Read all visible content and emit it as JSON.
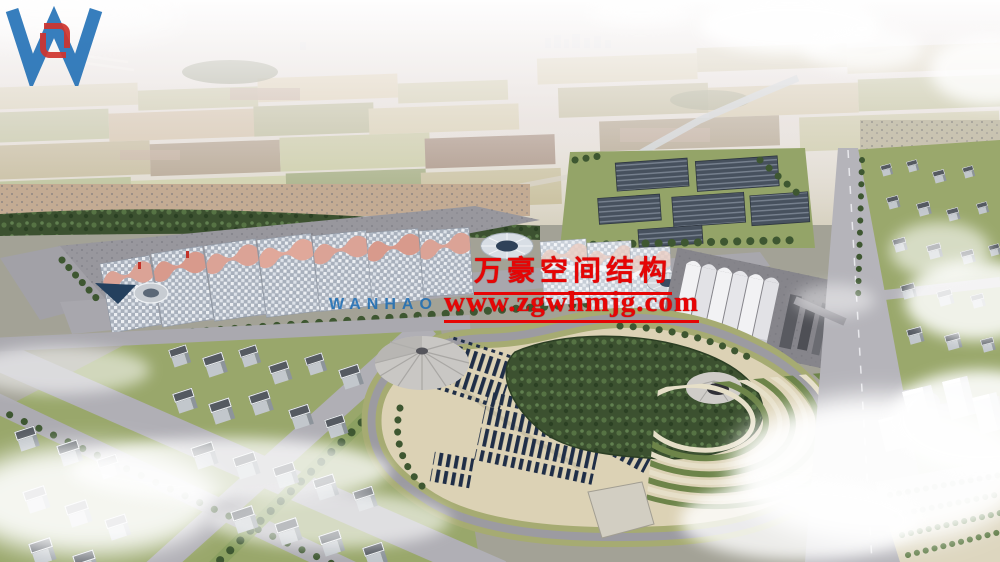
{
  "scene": {
    "type": "aerial-architectural-rendering",
    "subject": "exhibition center complex with pink wave-roof halls, domed pavilions, white tent hall, central landscaped park, residential blocks, highway and hazy farmland horizon"
  },
  "watermark": {
    "logo_letter_w": "W",
    "logo_caption": "WANHAO",
    "company_name": "万豪空间结构",
    "website": "www.zgwhmjg.com"
  },
  "colors": {
    "watermark_red": "#e60505",
    "logo_blue": "#1b6cb4",
    "logo_mark_red": "#cf342e",
    "roof_pink": "#dba396",
    "gridshell_gray": "#a8b0bc",
    "park_ground_tan": "#dcd2b5",
    "tree_green": "#3c5130",
    "water_blue": "#24405e",
    "haze_white": "#ffffff"
  }
}
